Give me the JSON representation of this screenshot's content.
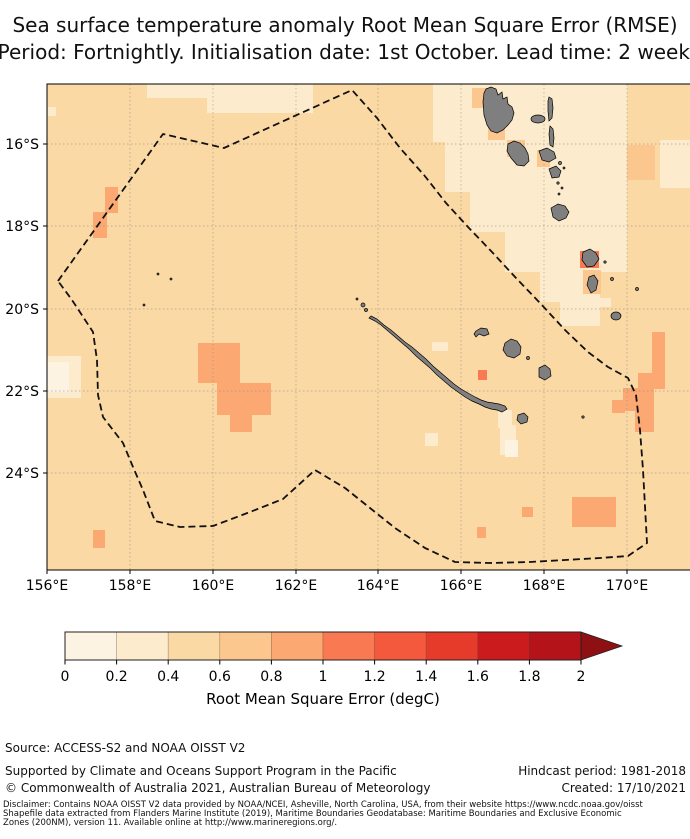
{
  "title": {
    "line1": "Sea surface temperature anomaly Root Mean Square Error (RMSE)",
    "line2": "Period: Fortnightly. Initialisation date: 1st October. Lead time: 2 weeks"
  },
  "footer": {
    "source": "Source: ACCESS-S2 and NOAA OISST V2",
    "supported": "Supported by Climate and Oceans Support Program in the Pacific",
    "copyright": "© Commonwealth of Australia 2021, Australian Bureau of Meteorology",
    "hindcast": "Hindcast period: 1981-2018",
    "created": "Created: 17/10/2021",
    "disclaimer_line1": "Disclaimer: Contains NOAA OISST V2 data provided by NOAA/NCEI, Asheville, North Carolina, USA, from their website https://www.ncdc.noaa.gov/oisst",
    "disclaimer_line2": "Shapefile data extracted from Flanders Marine Institute (2019), Maritime Boundaries Geodatabase: Maritime Boundaries and Exclusive Economic",
    "disclaimer_line3": "Zones (200NM), version 11. Available online at http://www.marineregions.org/."
  },
  "chart_data": {
    "type": "heatmap",
    "title": "Sea surface temperature anomaly Root Mean Square Error (RMSE)",
    "subtitle": "Period: Fortnightly. Initialisation date: 1st October. Lead time: 2 weeks",
    "region": "New Caledonia EEZ and Vanuatu, southwest Pacific",
    "x_axis": {
      "ticks": [
        "156°E",
        "158°E",
        "160°E",
        "162°E",
        "164°E",
        "166°E",
        "168°E",
        "170°E"
      ],
      "positions": [
        47,
        130,
        213,
        296,
        378,
        461,
        544,
        627
      ]
    },
    "y_axis": {
      "ticks": [
        "16°S",
        "18°S",
        "20°S",
        "22°S",
        "24°S"
      ],
      "positions": [
        144,
        226,
        309,
        391,
        473
      ]
    },
    "plot_area": {
      "x": 47,
      "y": 84,
      "width": 643,
      "height": 486
    },
    "grid": true,
    "boundary": "dashed EEZ boundary",
    "land_color": "#7f7f7f",
    "colorbar": {
      "label": "Root Mean Square Error (degC)",
      "ticks": [
        "0",
        "0.2",
        "0.4",
        "0.6",
        "0.8",
        "1",
        "1.2",
        "1.4",
        "1.6",
        "1.8",
        "2"
      ],
      "range": [
        0,
        2
      ],
      "extend": "max",
      "colors": [
        "#fdf3e3",
        "#fdebcd",
        "#fbd9a4",
        "#fcc68f",
        "#fca873",
        "#f97a52",
        "#f4593d",
        "#e63a2a",
        "#cb1b1d",
        "#b41319"
      ],
      "arrow_color": "#8f1013",
      "x": 65,
      "y": 632,
      "segment_width": 51.6,
      "height": 28,
      "arrow_tip_x": 622
    },
    "value_summary": [
      {
        "area": "most of the map (background)",
        "rmse_degC": "0.4-0.6"
      },
      {
        "area": "around northern Vanuatu, right column near 170E, and patches south of New Caledonia",
        "rmse_degC": "0.2-0.4"
      },
      {
        "area": "lightest cells at 156E 21.5S and just south of New Caledonia",
        "rmse_degC": "0-0.2"
      },
      {
        "area": "cells adjacent to Vanuatu islands and near Tanna",
        "rmse_degC": "0.6-0.8"
      },
      {
        "area": "patches near 157.5E 17.5-18.5S, 160.5-161.5E 21-23S and the southeast corner",
        "rmse_degC": "0.8-1.0"
      },
      {
        "area": "small cells beside Erromango and the New Caledonia east coast",
        "rmse_degC": "1.0-1.2"
      }
    ],
    "geometry": {
      "background_bin": 2,
      "patches": [
        {
          "bin": 1,
          "x": 147,
          "y": 84,
          "w": 62,
          "h": 14
        },
        {
          "bin": 1,
          "x": 207,
          "y": 84,
          "w": 106,
          "h": 29
        },
        {
          "bin": 1,
          "x": 48,
          "y": 107,
          "w": 8,
          "h": 9
        },
        {
          "bin": 1,
          "x": 433,
          "y": 84,
          "w": 194,
          "h": 58
        },
        {
          "bin": 1,
          "x": 445,
          "y": 142,
          "w": 182,
          "h": 50
        },
        {
          "bin": 1,
          "x": 470,
          "y": 192,
          "w": 157,
          "h": 40
        },
        {
          "bin": 1,
          "x": 505,
          "y": 232,
          "w": 122,
          "h": 40
        },
        {
          "bin": 1,
          "x": 540,
          "y": 272,
          "w": 60,
          "h": 30
        },
        {
          "bin": 1,
          "x": 560,
          "y": 302,
          "w": 40,
          "h": 24
        },
        {
          "bin": 1,
          "x": 660,
          "y": 140,
          "w": 30,
          "h": 48
        },
        {
          "bin": 1,
          "x": 498,
          "y": 410,
          "w": 14,
          "h": 18
        },
        {
          "bin": 1,
          "x": 500,
          "y": 425,
          "w": 16,
          "h": 30
        },
        {
          "bin": 1,
          "x": 425,
          "y": 433,
          "w": 13,
          "h": 13
        },
        {
          "bin": 1,
          "x": 432,
          "y": 342,
          "w": 16,
          "h": 9
        },
        {
          "bin": 1,
          "x": 47,
          "y": 356,
          "w": 34,
          "h": 42
        },
        {
          "bin": 1,
          "x": 599,
          "y": 298,
          "w": 12,
          "h": 9
        },
        {
          "bin": 0,
          "x": 47,
          "y": 362,
          "w": 22,
          "h": 30
        },
        {
          "bin": 0,
          "x": 505,
          "y": 440,
          "w": 13,
          "h": 17
        },
        {
          "bin": 3,
          "x": 472,
          "y": 88,
          "w": 18,
          "h": 20
        },
        {
          "bin": 3,
          "x": 488,
          "y": 123,
          "w": 17,
          "h": 17
        },
        {
          "bin": 3,
          "x": 507,
          "y": 140,
          "w": 18,
          "h": 17
        },
        {
          "bin": 3,
          "x": 537,
          "y": 150,
          "w": 13,
          "h": 17
        },
        {
          "bin": 3,
          "x": 583,
          "y": 270,
          "w": 18,
          "h": 24
        },
        {
          "bin": 3,
          "x": 627,
          "y": 145,
          "w": 28,
          "h": 35
        },
        {
          "bin": 4,
          "x": 105,
          "y": 187,
          "w": 13,
          "h": 26
        },
        {
          "bin": 4,
          "x": 93,
          "y": 212,
          "w": 14,
          "h": 26
        },
        {
          "bin": 4,
          "x": 198,
          "y": 343,
          "w": 42,
          "h": 40
        },
        {
          "bin": 4,
          "x": 217,
          "y": 383,
          "w": 54,
          "h": 32
        },
        {
          "bin": 4,
          "x": 230,
          "y": 415,
          "w": 22,
          "h": 17
        },
        {
          "bin": 4,
          "x": 93,
          "y": 530,
          "w": 12,
          "h": 18
        },
        {
          "bin": 4,
          "x": 652,
          "y": 332,
          "w": 13,
          "h": 41
        },
        {
          "bin": 4,
          "x": 638,
          "y": 373,
          "w": 27,
          "h": 16
        },
        {
          "bin": 4,
          "x": 623,
          "y": 388,
          "w": 31,
          "h": 23
        },
        {
          "bin": 4,
          "x": 612,
          "y": 400,
          "w": 13,
          "h": 13
        },
        {
          "bin": 4,
          "x": 635,
          "y": 411,
          "w": 19,
          "h": 21
        },
        {
          "bin": 4,
          "x": 572,
          "y": 497,
          "w": 44,
          "h": 30
        },
        {
          "bin": 4,
          "x": 522,
          "y": 507,
          "w": 11,
          "h": 10
        },
        {
          "bin": 4,
          "x": 477,
          "y": 527,
          "w": 9,
          "h": 11
        },
        {
          "bin": 5,
          "x": 580,
          "y": 251,
          "w": 19,
          "h": 17
        },
        {
          "bin": 5,
          "x": 478,
          "y": 370,
          "w": 9,
          "h": 10
        }
      ],
      "eez": [
        [
          58,
          281
        ],
        [
          163,
          134
        ],
        [
          224,
          148
        ],
        [
          352,
          90
        ],
        [
          377,
          118
        ],
        [
          400,
          148
        ],
        [
          424,
          175
        ],
        [
          446,
          203
        ],
        [
          468,
          227
        ],
        [
          492,
          252
        ],
        [
          516,
          278
        ],
        [
          540,
          303
        ],
        [
          565,
          330
        ],
        [
          588,
          352
        ],
        [
          608,
          367
        ],
        [
          628,
          378
        ],
        [
          636,
          395
        ],
        [
          640,
          430
        ],
        [
          643,
          470
        ],
        [
          647,
          543
        ],
        [
          628,
          556
        ],
        [
          600,
          558
        ],
        [
          565,
          560
        ],
        [
          530,
          562
        ],
        [
          490,
          563
        ],
        [
          455,
          562
        ],
        [
          425,
          548
        ],
        [
          395,
          528
        ],
        [
          370,
          508
        ],
        [
          345,
          488
        ],
        [
          315,
          470
        ],
        [
          283,
          499
        ],
        [
          250,
          512
        ],
        [
          213,
          526
        ],
        [
          180,
          527
        ],
        [
          155,
          521
        ],
        [
          143,
          490
        ],
        [
          133,
          467
        ],
        [
          123,
          443
        ],
        [
          103,
          417
        ],
        [
          98,
          395
        ],
        [
          97,
          360
        ],
        [
          93,
          332
        ],
        [
          72,
          300
        ]
      ],
      "islands": {
        "paths": [
          {
            "name": "grande-terre",
            "d": "M371,316 L377,319 L384,325 L391,330 L398,336 L405,342 L412,347 L419,353 L426,359 L433,366 L440,372 L447,378 L454,384 L461,389 L468,393 L475,397 L481,400 L487,402 L493,403 L499,404 L505,406 L507,409 L502,412 L497,410 L491,409 L485,407 L479,404 L472,401 L465,397 L458,392 L451,387 L444,381 L437,375 L430,368 L423,362 L416,356 L409,349 L402,343 L395,337 L388,331 L381,325 L375,321 L369,318 Z"
          },
          {
            "name": "espiritu-santo",
            "d": "M486,89 L491,87 L496,89 L498,95 L502,92 L503,99 L507,97 L508,104 L512,107 L514,113 L512,120 L508,125 L503,130 L497,133 L491,131 L487,125 L484,115 L483,102 L484,93 Z"
          },
          {
            "name": "malakula",
            "d": "M508,144 L514,141 L520,143 L525,148 L528,154 L529,161 L524,166 L517,165 L511,158 L507,151 Z"
          },
          {
            "name": "ambrym",
            "d": "M539,151 L547,148 L554,152 L556,158 L549,162 L542,160 Z"
          },
          {
            "name": "epi",
            "d": "M549,169 L556,166 L561,171 L559,177 L552,178 Z"
          },
          {
            "name": "efate",
            "d": "M551,208 L558,204 L565,206 L569,212 L566,218 L559,221 L553,217 Z"
          },
          {
            "name": "erromango",
            "d": "M583,252 L590,249 L596,253 L599,259 L594,266 L587,267 L582,260 Z"
          },
          {
            "name": "tanna",
            "d": "M589,277 L594,275 L598,281 L596,290 L591,293 L587,285 Z"
          },
          {
            "name": "maewo",
            "d": "M549,97 L552,99 L553,108 L552,118 L549,121 L548,111 L548,101 Z"
          },
          {
            "name": "pentecost",
            "d": "M550,126 L553,129 L554,138 L553,147 L550,145 L549,134 Z"
          },
          {
            "name": "ouvea",
            "d": "M476,331 L481,328 L487,329 L489,334 L484,336 L479,334 L476,337 L474,334 Z"
          },
          {
            "name": "lifou",
            "d": "M505,343 L511,339 L517,341 L521,347 L520,354 L514,358 L507,356 L503,350 Z"
          },
          {
            "name": "mare",
            "d": "M539,368 L545,365 L550,369 L551,376 L545,380 L539,377 Z"
          },
          {
            "name": "isle-of-pines",
            "d": "M518,415 L524,413 L528,417 L527,422 L521,424 L517,420 Z"
          }
        ],
        "ellipses": [
          {
            "name": "aoba",
            "cx": 538,
            "cy": 119,
            "rx": 7,
            "ry": 4
          },
          {
            "name": "aneityum",
            "cx": 616,
            "cy": 316,
            "rx": 5,
            "ry": 4
          }
        ],
        "dots": [
          [
            560,
            163,
            1.5
          ],
          [
            564,
            168,
            1
          ],
          [
            558,
            183,
            1.2
          ],
          [
            562,
            188,
            1
          ],
          [
            559,
            194,
            1
          ],
          [
            605,
            262,
            1.2
          ],
          [
            612,
            279,
            1.5
          ],
          [
            637,
            289,
            1.5
          ],
          [
            158,
            274,
            1
          ],
          [
            171,
            279,
            1
          ],
          [
            144,
            305,
            1
          ],
          [
            583,
            417,
            1.2
          ],
          [
            363,
            305,
            2
          ],
          [
            366,
            310,
            1.5
          ],
          [
            357,
            299,
            1
          ],
          [
            528,
            358,
            1.5
          ]
        ]
      }
    }
  }
}
